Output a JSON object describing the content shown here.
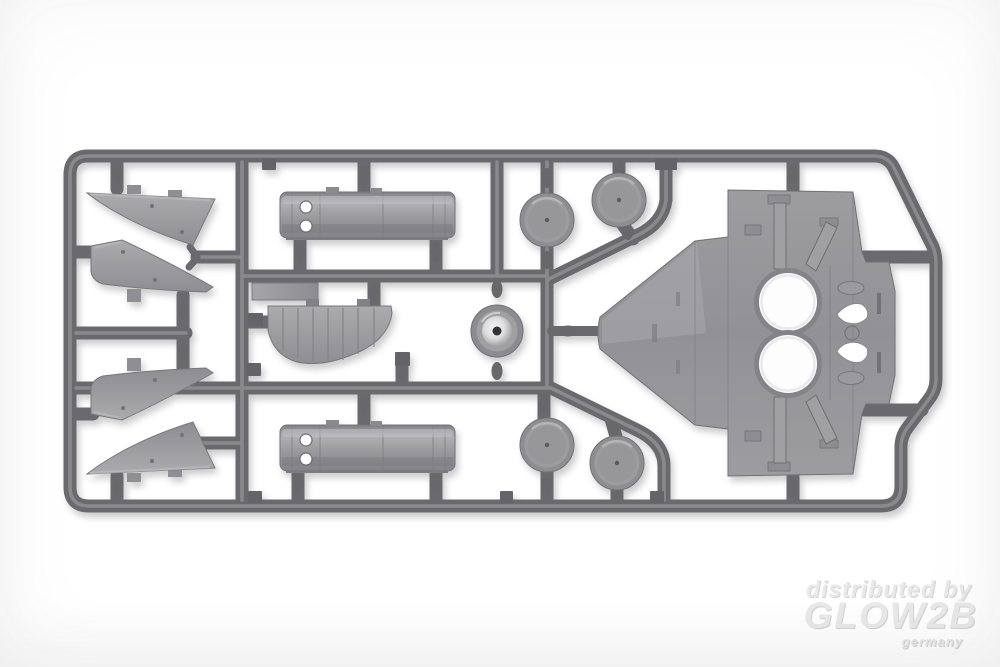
{
  "photo": {
    "description": "Product photo of a gray injection-molded plastic model kit sprue with aircraft parts on a white studio background",
    "background_color": "#ffffff",
    "sprue": {
      "runner_color": "#6b6b6e",
      "part_color": "#9a9a9d",
      "parts": [
        {
          "name": "tail-fin-panel",
          "count": 4
        },
        {
          "name": "fuselage-half-shell",
          "count": 2
        },
        {
          "name": "wheel-disc",
          "count": 4
        },
        {
          "name": "engine-cowling",
          "count": 1
        },
        {
          "name": "fuselage-center-section-with-round-openings",
          "count": 1
        },
        {
          "name": "ribbed-wing-center-section",
          "count": 1
        },
        {
          "name": "flat-rectangular-panel",
          "count": 1
        }
      ]
    }
  },
  "watermark": {
    "prefix": "distributed by",
    "brand": "GLOW2B",
    "country": "germany",
    "color": "#e9e9e9"
  }
}
